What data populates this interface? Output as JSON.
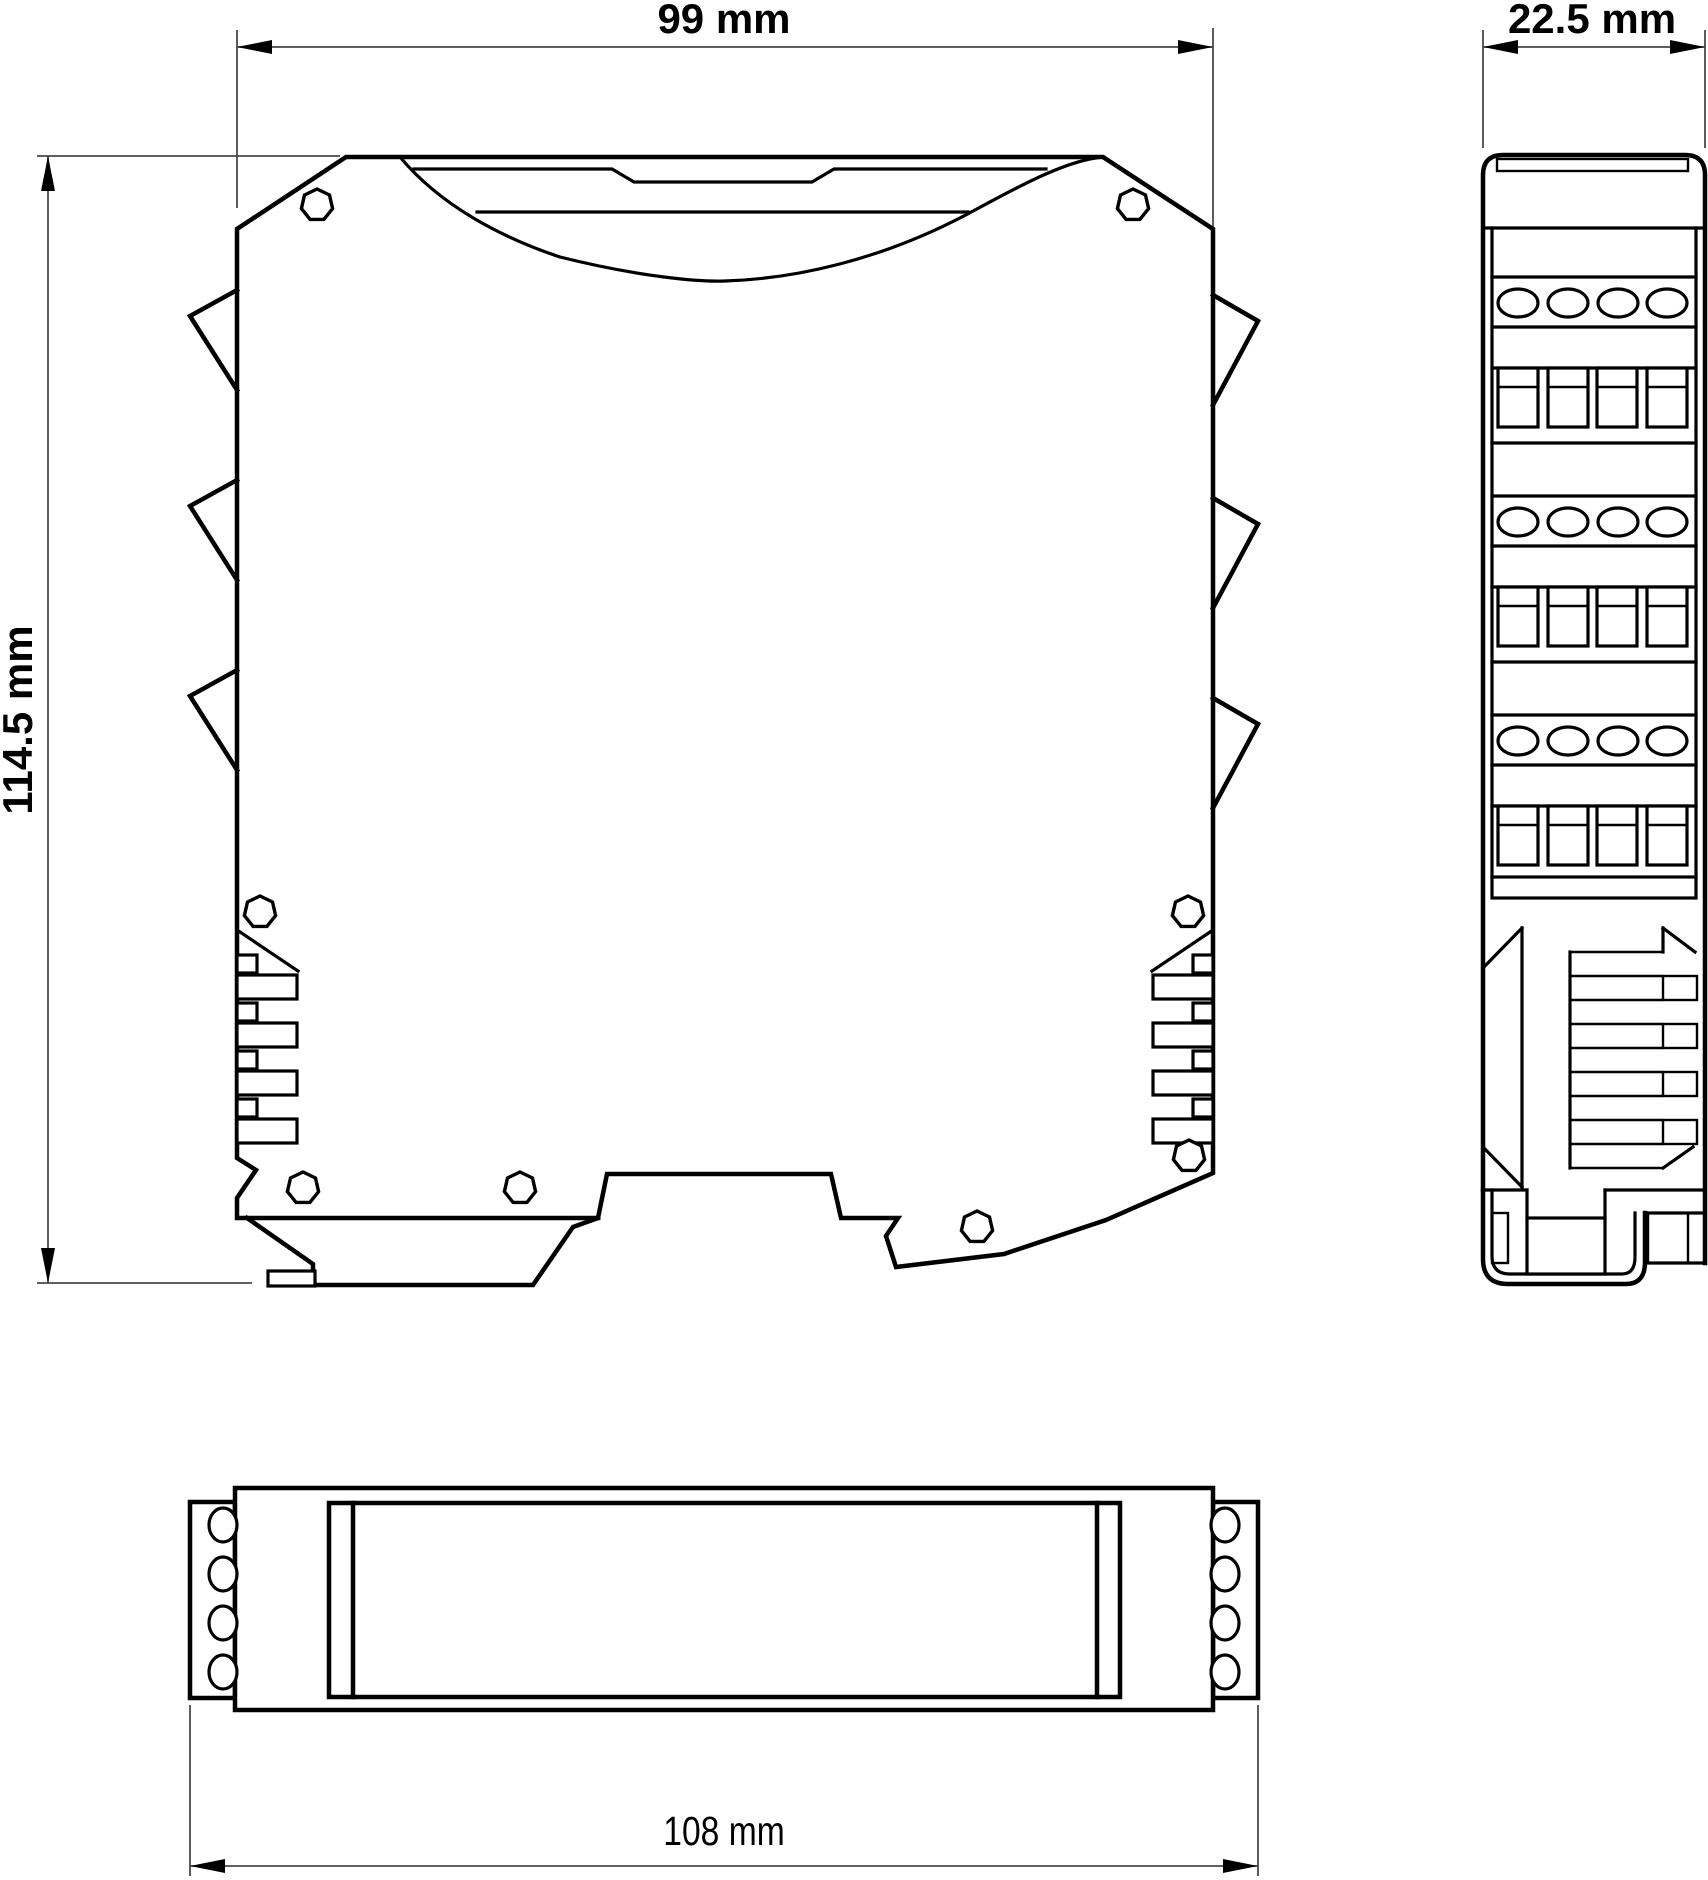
{
  "drawing": {
    "type": "dimensional-drawing-3-views",
    "dimensions": {
      "front_width": "99 mm",
      "side_depth": "22.5 mm",
      "front_height": "114.5 mm",
      "bottom_length": "108 mm"
    },
    "colors": {
      "line": "#000000",
      "dimension_line": "#4a4a4a",
      "background": "#ffffff"
    }
  }
}
